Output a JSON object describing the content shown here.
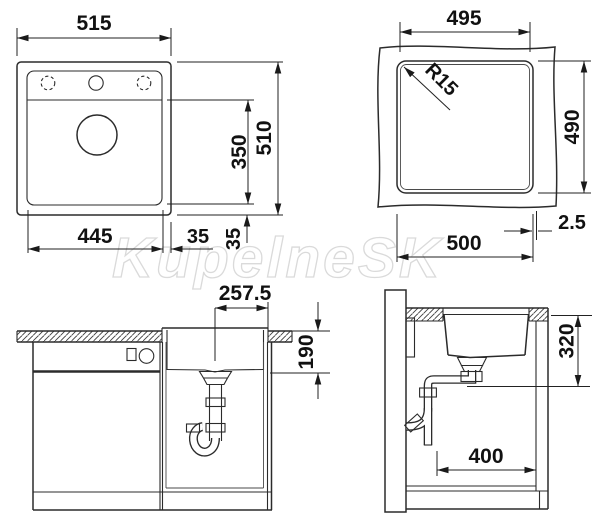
{
  "watermark": "KupelneSK",
  "views": {
    "top": {
      "overall_width": "515",
      "overall_depth": "510",
      "bowl_depth": "350",
      "bowl_width": "445",
      "right_margin": "35",
      "bottom_margin": "35"
    },
    "cutout": {
      "width_top": "495",
      "depth": "490",
      "corner_radius": "R15",
      "width_bottom": "500",
      "edge_offset": "2.5"
    },
    "front": {
      "drain_offset": "257.5",
      "depth_below_top": "190"
    },
    "side": {
      "outlet_height": "320",
      "min_clearance": "400"
    }
  }
}
